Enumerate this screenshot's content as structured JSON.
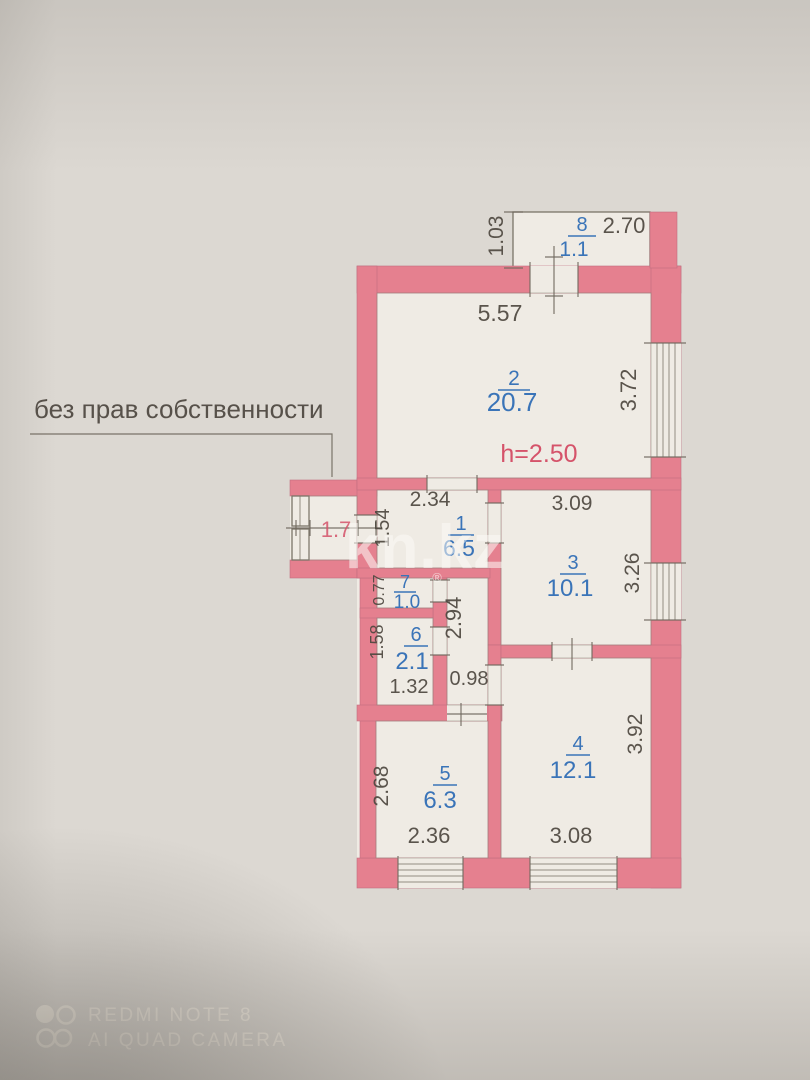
{
  "note": {
    "text": "без прав собственности"
  },
  "site_watermark": {
    "name": "kn.kz",
    "registered": "®"
  },
  "camera_watermark": {
    "line1": "REDMI NOTE 8",
    "line2": "AI QUAD CAMERA"
  },
  "plan": {
    "ceiling_height": "h=2.50",
    "balcony_area": "1.7",
    "rooms": [
      {
        "number": "8",
        "area": "1.1"
      },
      {
        "number": "2",
        "area": "20.7"
      },
      {
        "number": "1",
        "area": "6.5"
      },
      {
        "number": "3",
        "area": "10.1"
      },
      {
        "number": "7",
        "area": "1.0"
      },
      {
        "number": "6",
        "area": "2.1"
      },
      {
        "number": "5",
        "area": "6.3"
      },
      {
        "number": "4",
        "area": "12.1"
      }
    ],
    "dims": {
      "balcony8_width": "2.70",
      "balcony8_depth": "1.03",
      "room2_width": "5.57",
      "room2_height": "3.72",
      "room1_width": "2.34",
      "room1_height": "1.54",
      "room3_width": "3.09",
      "room3_height": "3.26",
      "room7_height": "0.77",
      "room6_height": "1.58",
      "room6_width": "1.32",
      "corridor_height": "2.94",
      "corridor_width": "0.98",
      "room5_height": "2.68",
      "room5_width": "2.36",
      "room4_height": "3.92",
      "room4_width": "3.08"
    }
  }
}
